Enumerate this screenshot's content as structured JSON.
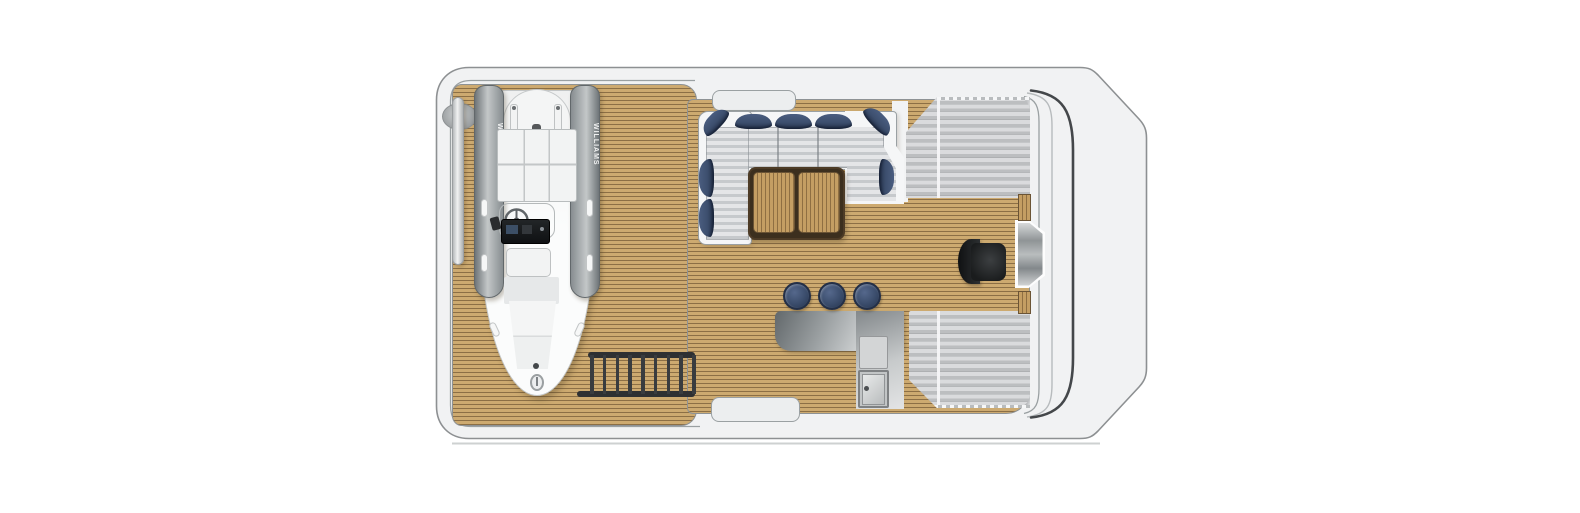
{
  "tender": {
    "brand": "WILLIAMS"
  },
  "counts": {
    "bar_stools": 3,
    "ladder_rungs": 9,
    "sofa_back_pillows": 3
  },
  "colors": {
    "hull_fill": "#f1f2f3",
    "hull_line": "#8d9092",
    "hull_inner_line": "#9aa0a2",
    "deck_teak_light": "#cdaa70",
    "deck_teak_dark": "#8c6f45",
    "table_teak_light": "#c49e63",
    "table_teak_dark": "#8f6f42",
    "table_border": "#4d3b26",
    "pad_stripe_light": "#dadbdd",
    "pad_stripe_dark": "#bcbec0",
    "sofa_stripe_light": "#e4e5e7",
    "sofa_stripe_dark": "#c6c9cc",
    "pillow_navy": "#3d4f6e",
    "pillow_navy_dark": "#27344d",
    "stainless_dark": "#62686b",
    "stainless_light": "#e0e2e3",
    "seat_black": "#1a1c1d",
    "ladder_dark": "#2e3032",
    "windshield_line": "#44474a"
  }
}
